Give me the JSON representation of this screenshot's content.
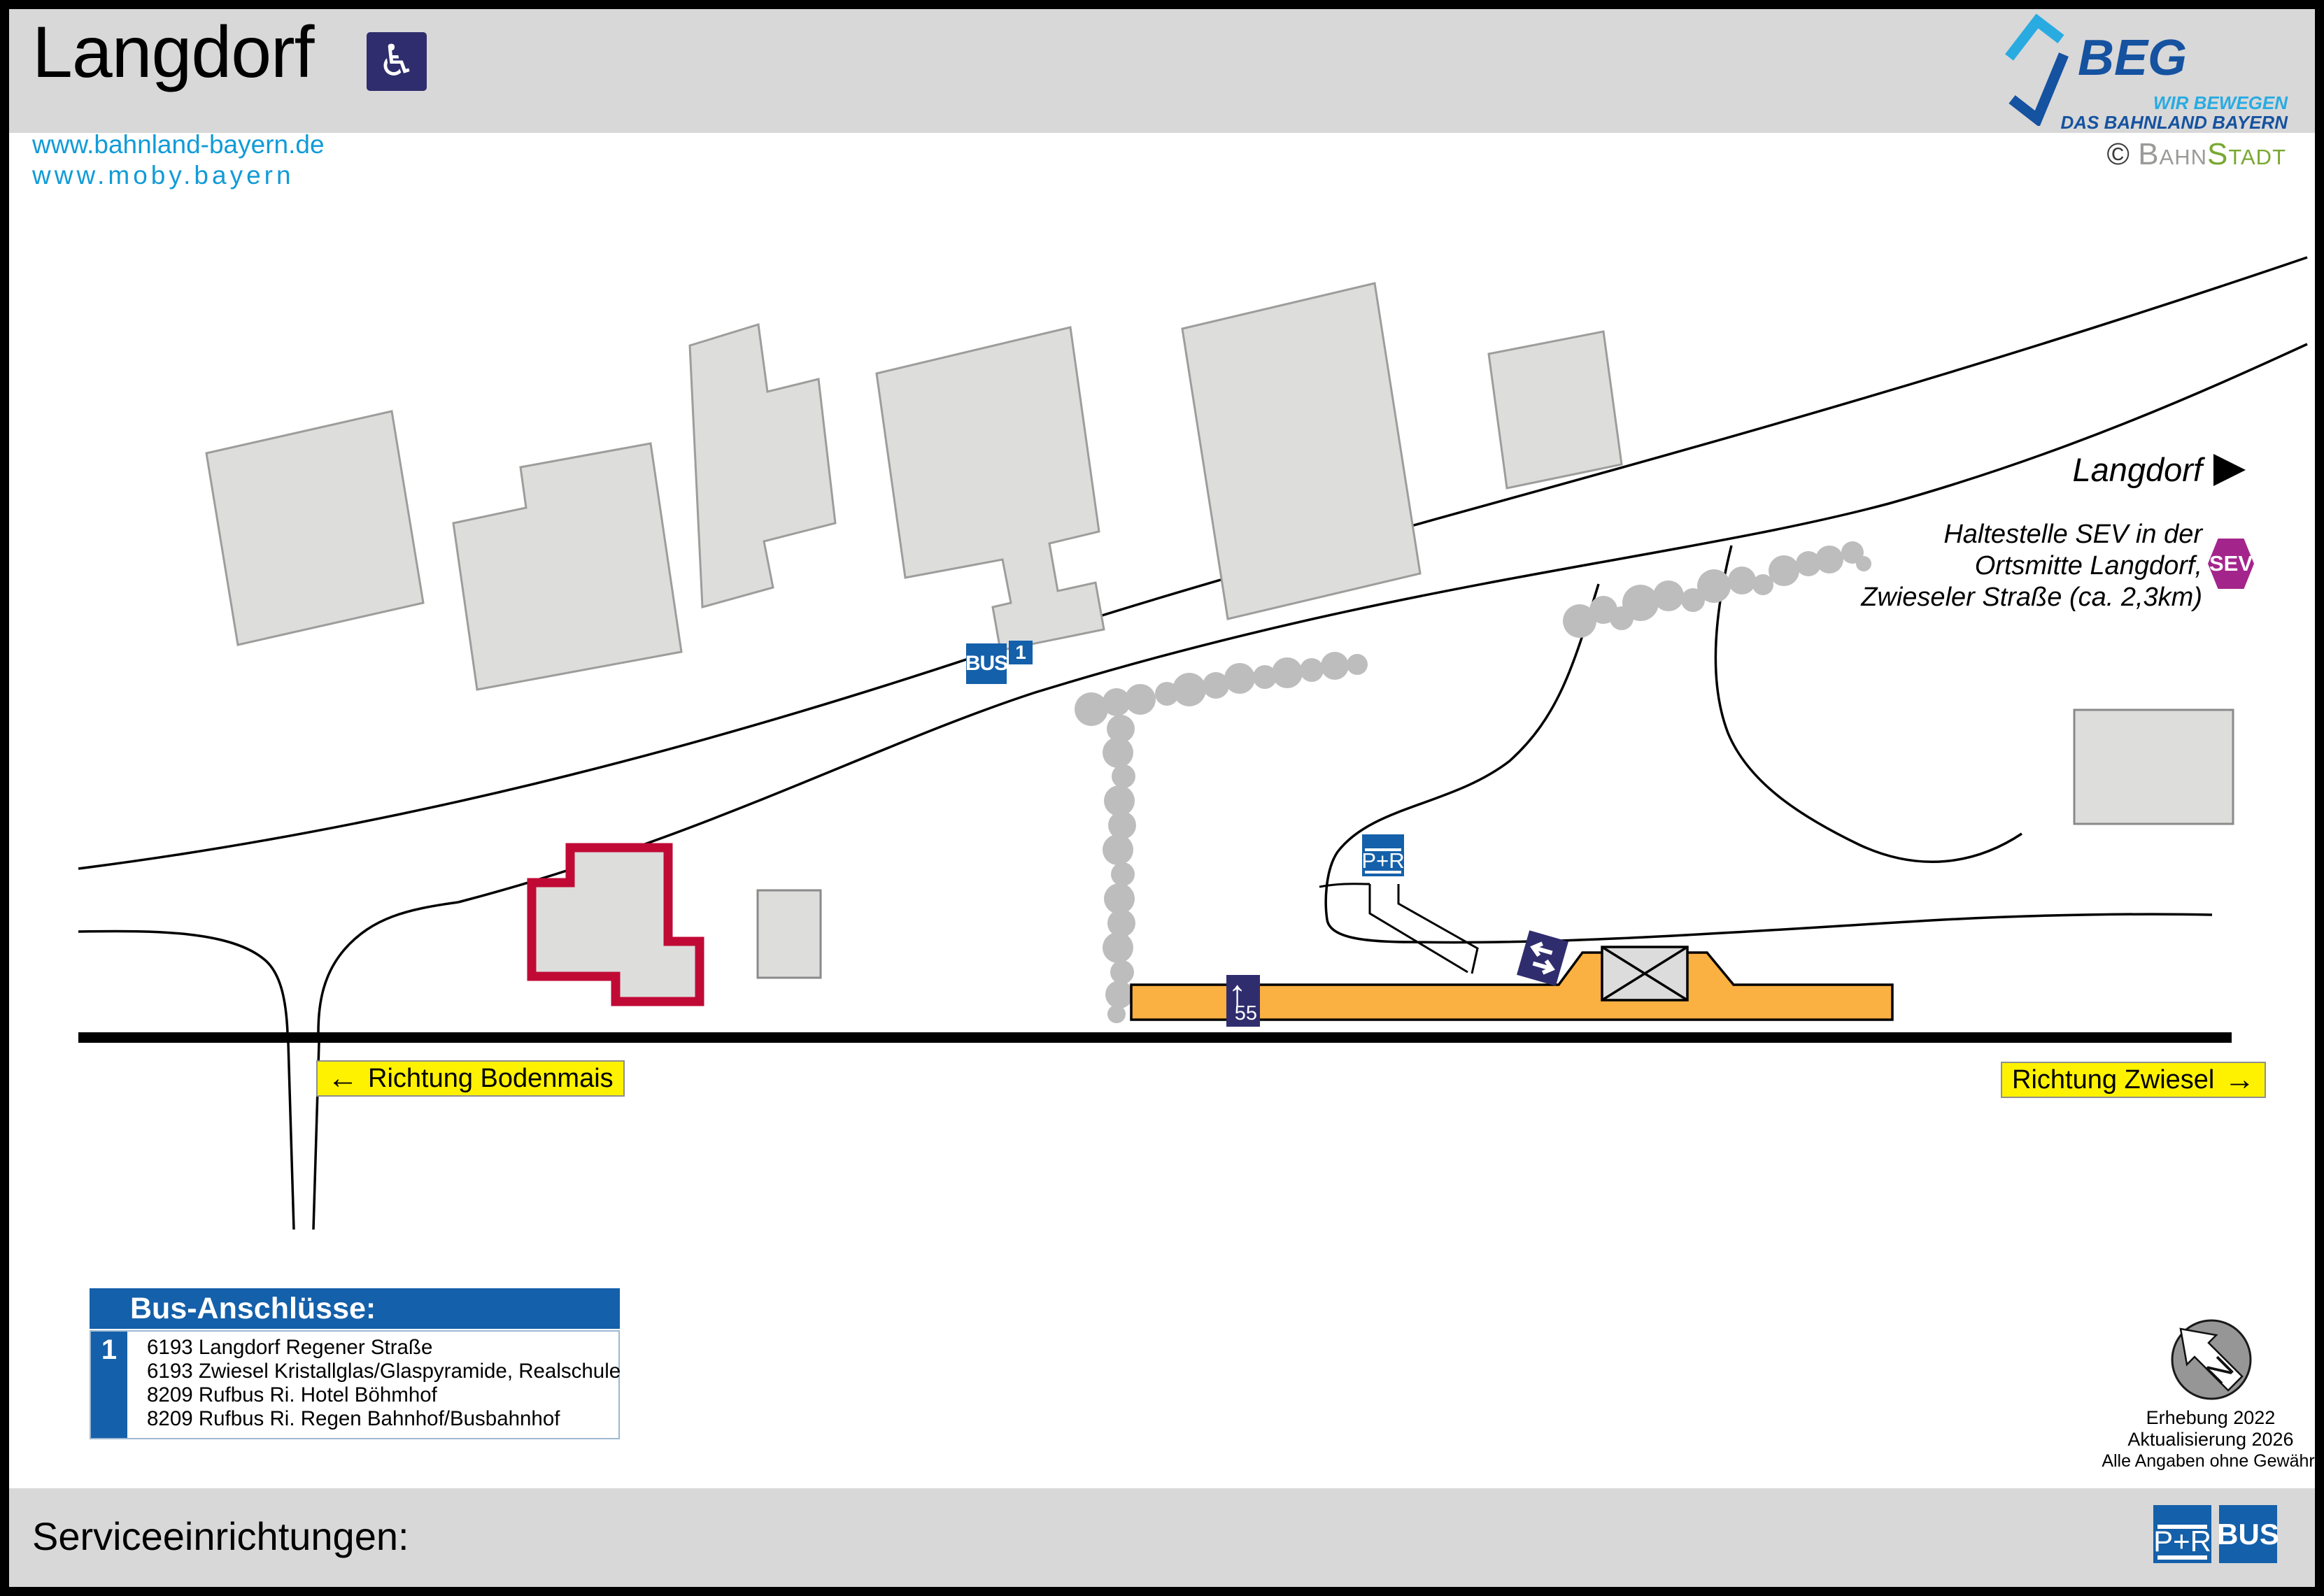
{
  "colors": {
    "header-gray": "#D8D8D8",
    "link-blue": "#119BD7",
    "brand-blue": "#1460AA",
    "brand-lightblue": "#29ABE2",
    "navy": "#302D6E",
    "orange": "#FBB042",
    "yellow": "#FFF200",
    "purple": "#A3258C",
    "red": "#C00A35",
    "green": "#79A832",
    "building-gray": "#DDDDDC",
    "tree-gray": "#BDBDBD"
  },
  "header": {
    "title": "Langdorf",
    "wheelchair_icon": "♿",
    "beg": {
      "name": "BEG",
      "tagline1": "WIR BEWEGEN",
      "tagline2": "DAS BAHNLAND BAYERN"
    }
  },
  "links": {
    "url1": "www.bahnland-bayern.de",
    "url2": "www.moby.bayern"
  },
  "credit": {
    "symbol": "©",
    "part1": "Bahn",
    "part2": "Stadt"
  },
  "map": {
    "direction_label": "Langdorf",
    "direction_arrow": "▶",
    "sev_note": {
      "line1": "Haltestelle SEV in der",
      "line2": "Ortsmitte Langdorf,",
      "line3": "Zwieseler Straße (ca. 2,3km)"
    },
    "sev_badge": "SEV",
    "bus_stop": {
      "label": "BUS",
      "number": "1"
    },
    "park_ride": "P+R",
    "platform_sign": {
      "arrow": "↑",
      "number": "55"
    },
    "direction_left_sign": {
      "arrow": "←",
      "label": "Richtung Bodenmais"
    },
    "direction_right_sign": {
      "label": "Richtung Zwiesel",
      "arrow": "→"
    },
    "compass_n": "N"
  },
  "legend": {
    "title": "Bus-Anschlüsse:",
    "badge": "1",
    "lines": [
      "6193 Langdorf Regener Straße",
      "6193 Zwiesel Kristallglas/Glaspyramide, Realschule",
      "8209 Rufbus Ri. Hotel Böhmhof",
      "8209 Rufbus Ri. Regen Bahnhof/Busbahnhof"
    ]
  },
  "notes": {
    "line1": "Erhebung 2022",
    "line2": "Aktualisierung 2026",
    "line3": "Alle Angaben ohne Gewähr!"
  },
  "service_bar": {
    "label": "Serviceeinrichtungen:",
    "park_ride": "P+R",
    "bus": "BUS"
  }
}
